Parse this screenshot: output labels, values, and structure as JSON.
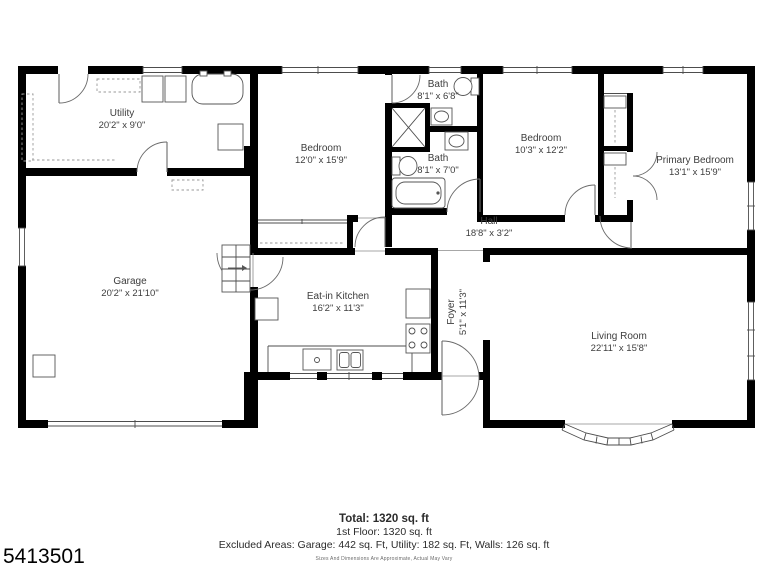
{
  "plan": {
    "rooms": [
      {
        "id": "utility",
        "name": "Utility",
        "dims": "20'2\" x 9'0\"",
        "x": 122,
        "y": 108,
        "rotate": false
      },
      {
        "id": "bedroom",
        "name": "Bedroom",
        "dims": "12'0\" x 15'9\"",
        "x": 321,
        "y": 143,
        "rotate": false
      },
      {
        "id": "bath-top",
        "name": "Bath",
        "dims": "8'1\" x 6'8\"",
        "x": 438,
        "y": 79,
        "rotate": false
      },
      {
        "id": "bath-bottom",
        "name": "Bath",
        "dims": "8'1\" x 7'0\"",
        "x": 438,
        "y": 153,
        "rotate": false
      },
      {
        "id": "bedroom-2",
        "name": "Bedroom",
        "dims": "10'3\" x 12'2\"",
        "x": 541,
        "y": 133,
        "rotate": false
      },
      {
        "id": "primary-bedroom",
        "name": "Primary Bedroom",
        "dims": "13'1\" x 15'9\"",
        "x": 695,
        "y": 155,
        "rotate": false
      },
      {
        "id": "hall",
        "name": "Hall",
        "dims": "18'8\" x 3'2\"",
        "x": 489,
        "y": 216,
        "rotate": false
      },
      {
        "id": "garage",
        "name": "Garage",
        "dims": "20'2\" x 21'10\"",
        "x": 130,
        "y": 276,
        "rotate": false
      },
      {
        "id": "eat-in-kitchen",
        "name": "Eat-in Kitchen",
        "dims": "16'2\" x 11'3\"",
        "x": 338,
        "y": 291,
        "rotate": false
      },
      {
        "id": "foyer",
        "name": "Foyer",
        "dims": "5'1\" x 11'3\"",
        "x": 457,
        "y": 312,
        "rotate": true
      },
      {
        "id": "living-room",
        "name": "Living Room",
        "dims": "22'11\" x 15'8\"",
        "x": 619,
        "y": 331,
        "rotate": false
      }
    ],
    "fixtures": [
      "washer",
      "dryer",
      "laundry-tub",
      "freezer",
      "water-heater",
      "stairs",
      "kitchen-counter",
      "kitchen-sink",
      "dishwasher",
      "stove",
      "refrigerator",
      "pantry",
      "toilet",
      "shower",
      "bathtub",
      "vanity-sink",
      "closet-rod",
      "bow-window"
    ]
  },
  "summary": {
    "total": "Total: 1320 sq. ft",
    "first_floor": "1st Floor: 1320 sq. ft",
    "excluded": "Excluded Areas: Garage: 442 sq. Ft, Utility: 182 sq. Ft, Walls: 126 sq. ft",
    "disclaimer": "Sizes And Dimensions Are Approximate, Actual May Vary"
  },
  "photo_id": "5413501",
  "colors": {
    "wall": "#000000",
    "background": "#ffffff",
    "label_text": "#3d3d3d",
    "fixture_line": "#555555"
  }
}
